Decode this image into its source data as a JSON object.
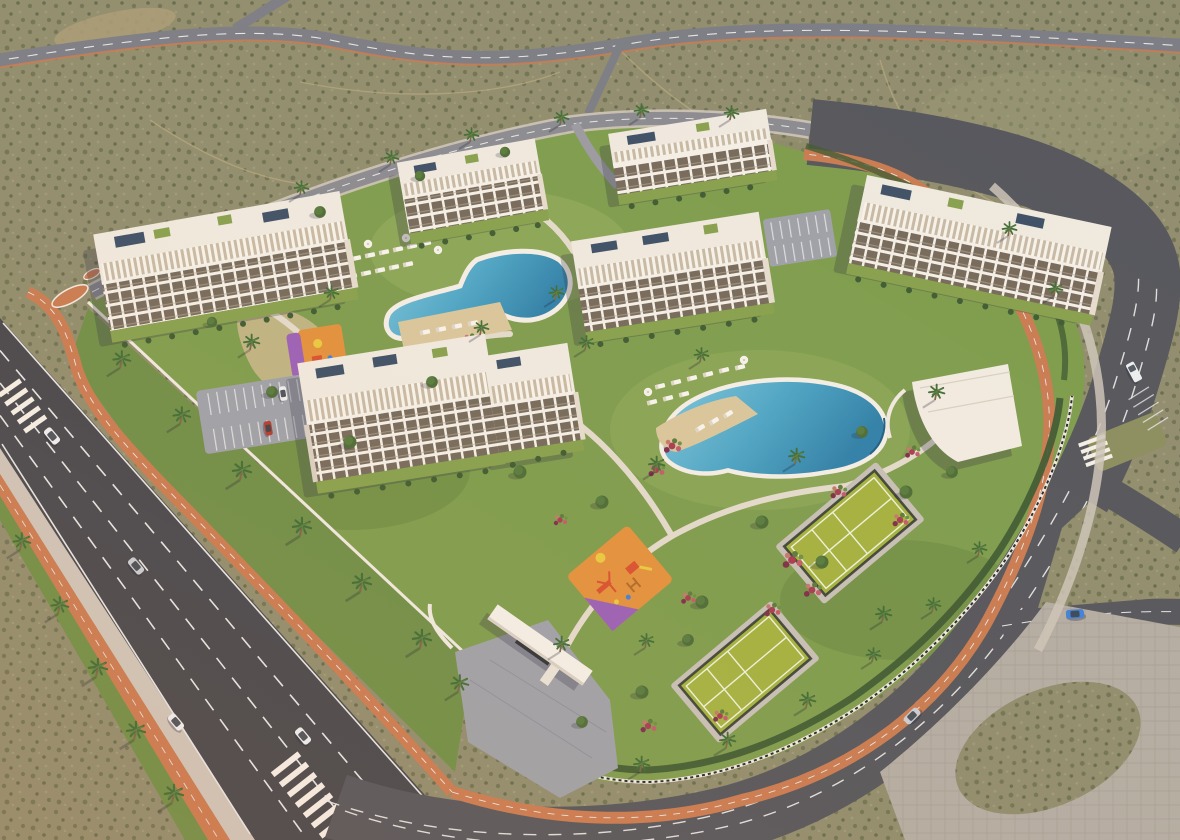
{
  "meta": {
    "type": "architectural-aerial-render",
    "description": "Aerial 3D visualization of a gated residential resort complex surrounded by desert scrubland and perimeter roads, rendered at warm golden-hour light",
    "visible_text": "none"
  },
  "palette": {
    "desert": "#8f8c6d",
    "desert-speck-dark": "#5f6648",
    "desert-speck": "#6b7050",
    "desert-speck-light": "#9c9a78",
    "sand-patch": "#a89a76",
    "trail": "#b3a47c",
    "highway": "#7b7c85",
    "road": "#45464c",
    "road-light": "#54555b",
    "marking": "#e6e6e6",
    "bike": "#c97a50",
    "sidewalk": "#cdc4b9",
    "paving": "#b3aca3",
    "plaza": "#9da0a8",
    "grass": "#7d9c4c",
    "grass-light": "#95ad5d",
    "grass-dark": "#5f7f3c",
    "verge": "#6e8e46",
    "hedge": "#3e5a31",
    "tree": "#4c6b36",
    "tree-light": "#5d8040",
    "palm-frond": "#3f6b35",
    "trunk": "#7a6548",
    "path": "#e3dacc",
    "wall-white": "#efe9e0",
    "roof": "#efe9df",
    "facade-slab": "#f4efe7",
    "wall-shade": "#d9cfc3",
    "window": "#75695a",
    "end-wall": "#e5dbcd",
    "garden": "#86a04c",
    "pool-deep": "#2e7fa8",
    "pool-mid": "#4aa3c4",
    "pool-light": "#7cc6de",
    "deck-sand": "#d9c69c",
    "court": "#a3b13f",
    "court-line": "#eef2dc",
    "fence": "#2a332e",
    "play-orange": "#e2903c",
    "play-purple": "#9a5fb5",
    "equip-red": "#d84f2f",
    "equip-yellow": "#e8c840",
    "flower-magenta": "#a83a52",
    "flower-pink": "#c25a6a",
    "car-white": "#eceef0",
    "car-silver": "#c8ccd3",
    "car-red": "#b43a2e",
    "car-blue": "#3f80d8",
    "glass": "#39404a",
    "solar": "#3d4f66",
    "shadow": "rgba(45,45,70,0.28)",
    "gate-canopy": "#f4f0e8"
  },
  "scene": {
    "site": {
      "apartment_buildings": 6,
      "floors_visible": 4,
      "roof_features": [
        "pergolas",
        "solar-panels",
        "roof-gardens"
      ]
    },
    "amenities": [
      "curved-lap-pool",
      "lagoon-pool-with-beach-deck",
      "sun-loungers",
      "parasols",
      "padel-court-upper",
      "padel-court-lower",
      "children-playground",
      "toddler-playground",
      "clubhouse",
      "entrance-gate-canopy",
      "parking-lot",
      "street-parking-bays"
    ],
    "roads": {
      "boulevard_lanes": 4,
      "bike_lane_color_name": "terracotta",
      "crosswalks": 3
    },
    "vehicles": {
      "white_cars": 4,
      "silver_cars": 2,
      "blue_cars": 1,
      "red_parked_cars": 1
    },
    "vegetation": [
      "palm-trees",
      "round-trees",
      "hedges",
      "bougainvillea-beds",
      "desert-scrub"
    ]
  }
}
